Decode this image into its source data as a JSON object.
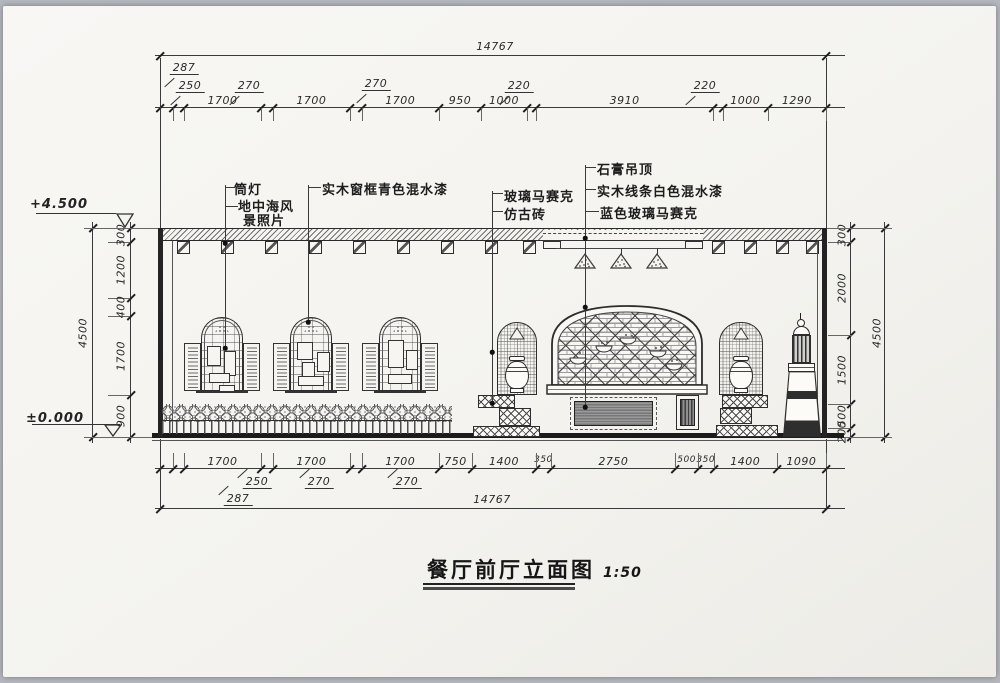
{
  "title": {
    "text": "餐厅前厅立面图",
    "scale": "1:50"
  },
  "levels": {
    "top": "+4.500",
    "bottom": "±0.000"
  },
  "annotations": {
    "downlight": "筒灯",
    "photo_line1": "地中海风",
    "photo_line2": "景照片",
    "window_frame_paint": "实木窗框青色混水漆",
    "glass_mosaic": "玻璃马赛克",
    "antique_brick": "仿古砖",
    "gypsum_ceiling": "石膏吊顶",
    "wood_trim_paint": "实木线条白色混水漆",
    "blue_glass_mosaic": "蓝色玻璃马赛克"
  },
  "dimensions": {
    "overall_top": "14767",
    "overall_bottom": "14767",
    "top_row": [
      "287",
      "250",
      "1700",
      "270",
      "1700",
      "270",
      "1700",
      "950",
      "1000",
      "220",
      "3910",
      "220",
      "1000",
      "1290"
    ],
    "bottom_row": [
      "287",
      "250",
      "1700",
      "270",
      "1700",
      "270",
      "1700",
      "750",
      "1400",
      "350",
      "2750",
      "500",
      "350",
      "1400",
      "1090"
    ],
    "left_column": {
      "segments": [
        "300",
        "1200",
        "400",
        "1700",
        "900"
      ],
      "total": "4500"
    },
    "right_column": {
      "segments": [
        "300",
        "2000",
        "1500",
        "500",
        "200"
      ],
      "total": "4500"
    }
  },
  "colors": {
    "ink": "#3a3a3a",
    "heavy": "#1d1d1d",
    "paper": "#f5f4f0"
  }
}
